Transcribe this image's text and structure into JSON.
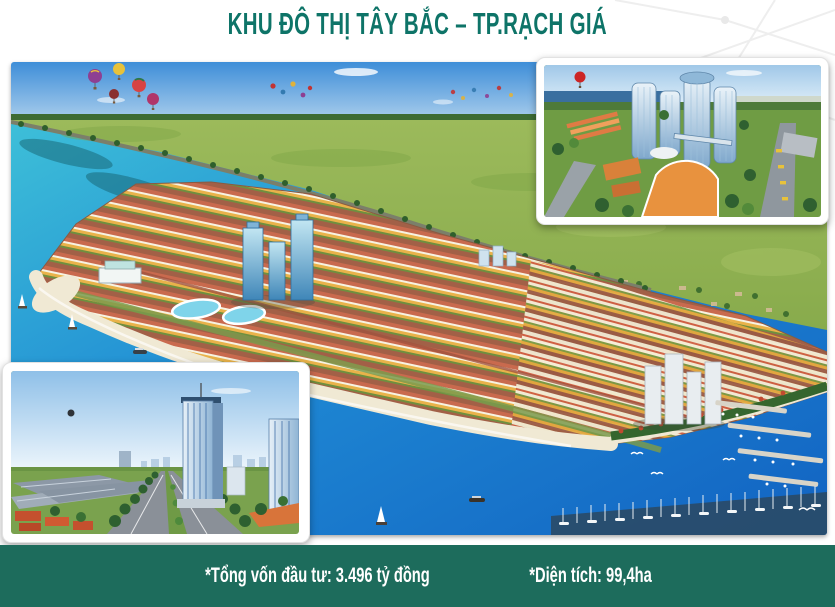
{
  "header": {
    "title": "KHU ĐÔ THỊ TÂY BẮC – TP.RẠCH GIÁ"
  },
  "footer": {
    "investment": "*Tổng vốn đầu tư: 3.496 tỷ đồng",
    "area": "*Diện tích: 99,4ha"
  },
  "palette": {
    "title_teal": "#0e7468",
    "footer_green": "#1d6c5c",
    "sky_blue": "#3e8ed8",
    "field_green": "#94b557",
    "sea_turquoise": "#35b9d6",
    "sea_deep": "#1263c2",
    "sand": "#f0e9d4"
  },
  "figures": {
    "main": {
      "name": "aerial-masterplan-render",
      "elements": [
        "sky",
        "clouds",
        "hot-air-balloons",
        "birds",
        "green-fields",
        "tree-lined-dyke-road",
        "row-house-blocks",
        "blue-glass-towers",
        "white-towers",
        "lagoon-pools",
        "beach",
        "turquoise-sea",
        "sailboats",
        "marina-piers",
        "yacht-row",
        "seagulls"
      ]
    },
    "inset_top_right": {
      "name": "towers-closeup-render",
      "elements": [
        "red-balloon",
        "glass-towers",
        "orange-podium",
        "orange-row-houses",
        "roads",
        "yellow-buses",
        "trees",
        "sea-horizon"
      ]
    },
    "inset_bottom_left": {
      "name": "boulevard-street-render",
      "elements": [
        "sky",
        "dark-balloon",
        "glass-tower",
        "warehouses",
        "red-roof-houses",
        "tree-lined-boulevard",
        "distant-skyline"
      ]
    }
  }
}
